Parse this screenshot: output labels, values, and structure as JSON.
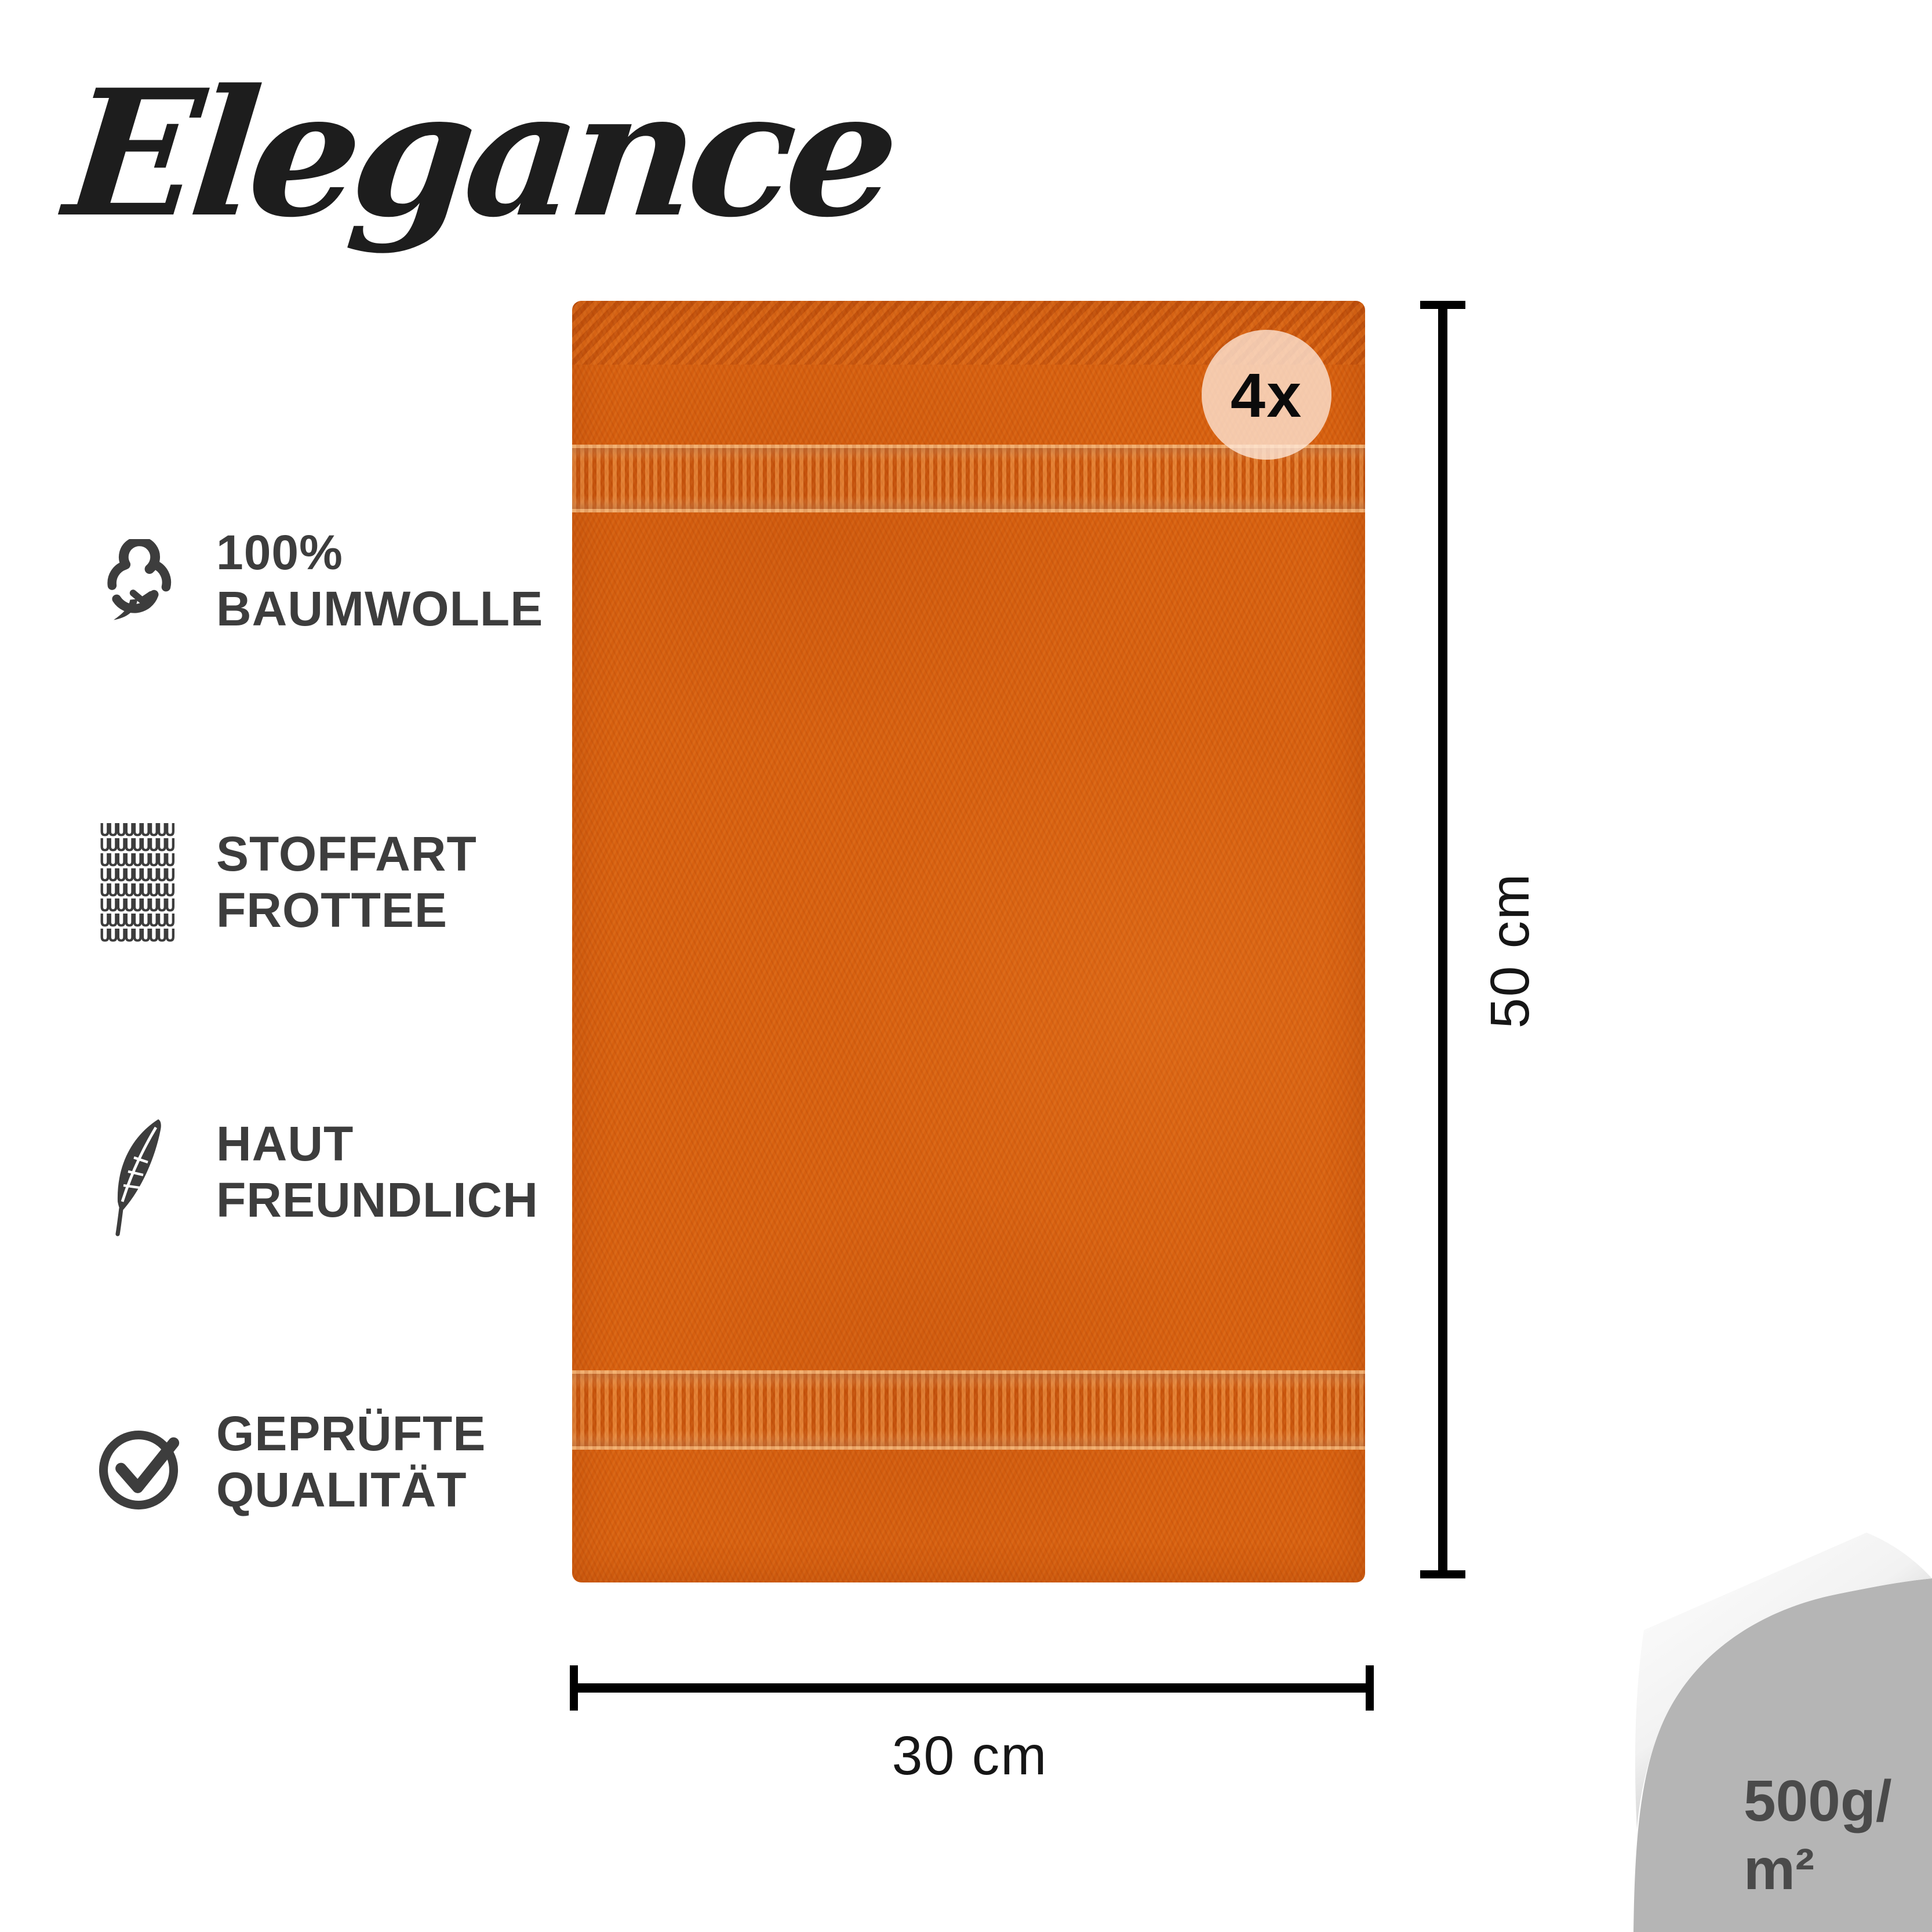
{
  "brand": {
    "logo_text": "Elegance"
  },
  "features": [
    {
      "icon": "cotton-icon",
      "line1": "100%",
      "line2": "BAUMWOLLE"
    },
    {
      "icon": "fabric-texture-icon",
      "line1": "STOFFART",
      "line2": "FROTTEE"
    },
    {
      "icon": "feather-icon",
      "line1": "HAUT",
      "line2": "FREUNDLICH"
    },
    {
      "icon": "check-circle-icon",
      "line1": "GEPRÜFTE",
      "line2": "QUALITÄT"
    }
  ],
  "towel": {
    "quantity_badge": "4x",
    "height_label": "50 cm",
    "width_label": "30 cm",
    "color_hex": "#d7600f"
  },
  "weight": {
    "line1": "500g/",
    "line2": "m²"
  },
  "icons": {
    "fabric_row": "UUUUUUUUU"
  },
  "colors": {
    "towel_orange": "#d7600f",
    "badge_background": "#f4c9ad",
    "corner_gray": "#b5b5b5",
    "feature_text": "#3d3d3d",
    "dimension_black": "#000000",
    "weight_text": "#4a4a4a"
  }
}
